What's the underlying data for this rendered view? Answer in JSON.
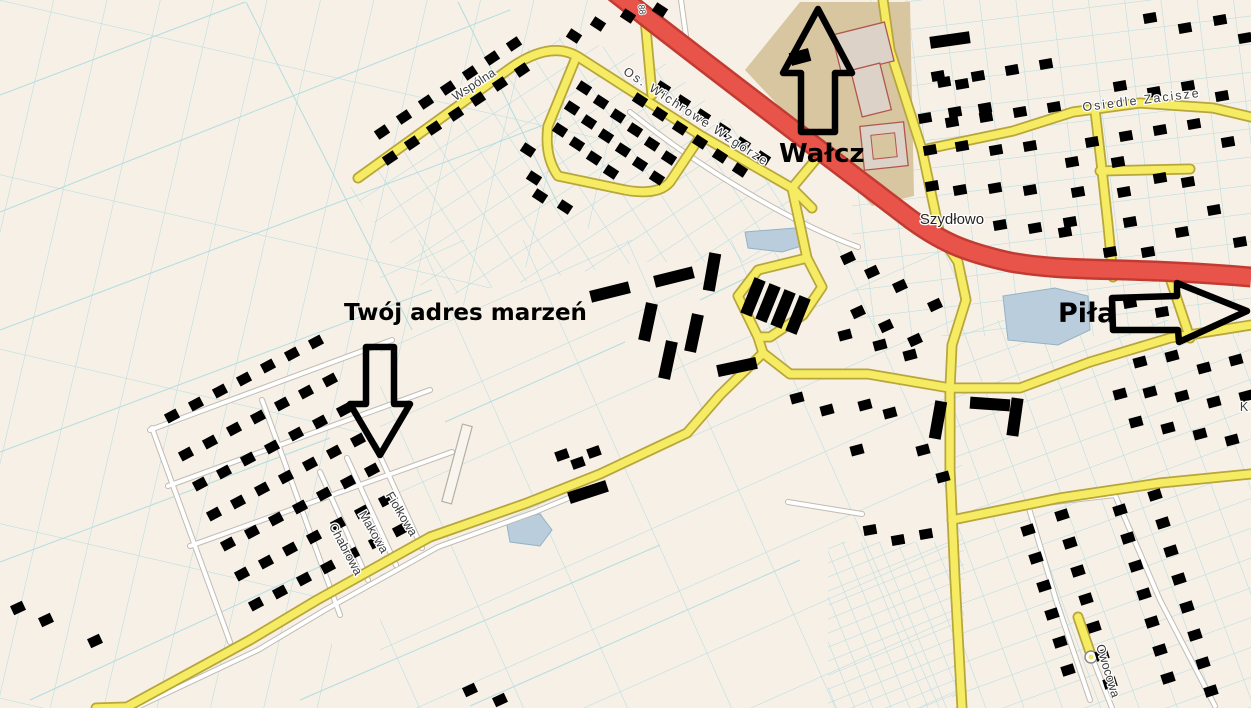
{
  "map": {
    "place_labels": {
      "szydlowo": "Szydłowo"
    },
    "street_labels": {
      "wspolna": "Wspólna",
      "wichrowe": "Os. Wichrowe Wzgórze",
      "zacisze": "Osiedle Zacisze",
      "fiolkowa": "Fiołkowa",
      "makowa": "Makowa",
      "chabrowa": "Chabrowa",
      "owocowa": "Owocowa",
      "partial_k": "K",
      "plot_number": "88"
    },
    "annotations": {
      "north": "Wałcz",
      "east": "Piła",
      "dream_address": "Twój adres marzeń"
    },
    "colors": {
      "background": "#f6f0e6",
      "parcel_line": "#a7d9e1",
      "road_primary": "#e85449",
      "road_primary_casing": "#c23b32",
      "road_secondary": "#f6ec63",
      "road_secondary_casing": "#b8a53b",
      "road_minor": "#ffffff",
      "water": "#b9cddd",
      "building_fill": "#efd7cf",
      "building_outline": "#bc5a5e",
      "large_building_fill": "#ddd2c8",
      "school_grounds": "#d8c6a1",
      "annotation_color": "#000000"
    }
  }
}
